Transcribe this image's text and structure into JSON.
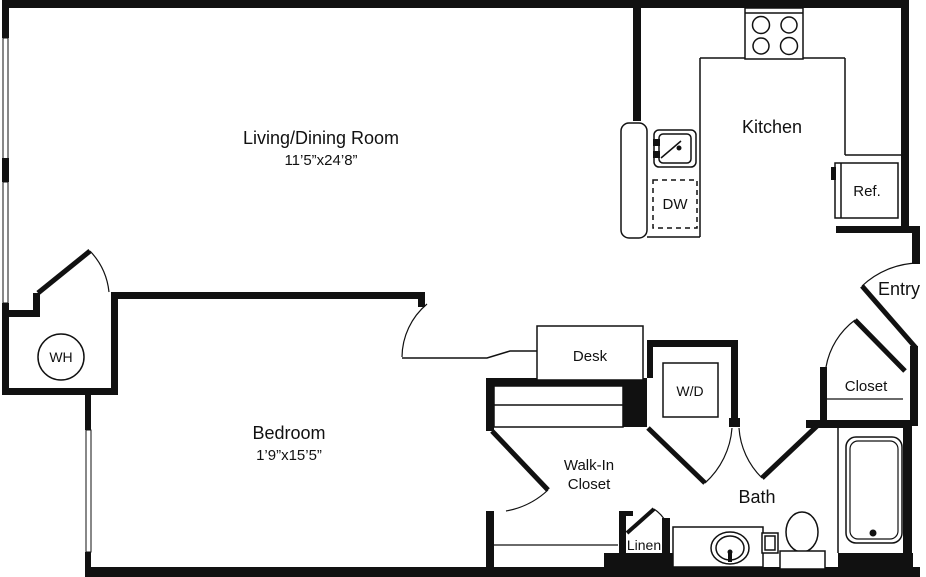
{
  "floor_plan": {
    "rooms": {
      "living_dining": {
        "label": "Living/Dining Room",
        "dims": "11’5”x24’8”"
      },
      "kitchen": {
        "label": "Kitchen"
      },
      "bedroom": {
        "label": "Bedroom",
        "dims": "1’9”x15’5”"
      },
      "bath": {
        "label": "Bath"
      },
      "entry": {
        "label": "Entry"
      },
      "walk_in_closet": {
        "label_line1": "Walk-In",
        "label_line2": "Closet"
      },
      "entry_closet": {
        "label": "Closet"
      },
      "linen_closet": {
        "label": "Linen"
      }
    },
    "fixtures": {
      "water_heater": {
        "label": "WH"
      },
      "dishwasher": {
        "label": "DW"
      },
      "refrigerator": {
        "label": "Ref."
      },
      "washer_dryer": {
        "label": "W/D"
      },
      "desk": {
        "label": "Desk"
      }
    },
    "colors": {
      "wall": "#111111",
      "background": "#ffffff"
    }
  }
}
